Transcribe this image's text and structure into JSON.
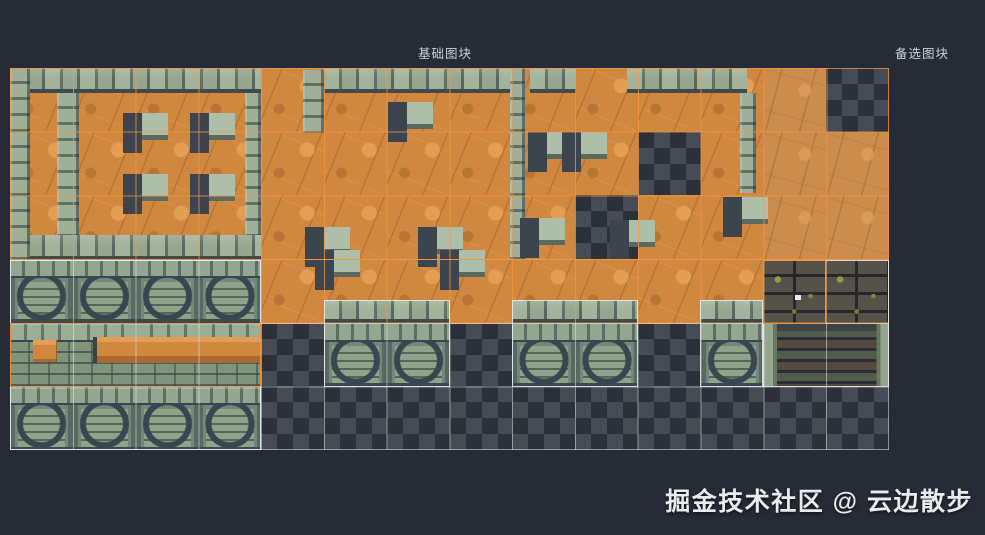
{
  "labels": {
    "base_tiles": "基础图块",
    "alt_tiles": "备选图块"
  },
  "watermark": "掘金技术社区 @ 云边散步",
  "colors": {
    "background": "#262b36",
    "accent_orange_grid": "#f59642",
    "selection_orange": "#ef9140",
    "outline_white": "#e9eef2",
    "floor_orange": "#d0883f",
    "floor_tan": "#cc8c4b",
    "wall_green_light": "#a3b29b",
    "wall_green_dark": "#5f7065",
    "wall_face": "#74877b",
    "dark_stone": "#4b4a43",
    "moss_green": "#8d9c40",
    "checker_light": "#474c54",
    "checker_dark": "#2c3038",
    "label_text": "#ccd2db",
    "watermark_text": "#e9ebef"
  },
  "tileset": {
    "origin_x": 10,
    "origin_y": 68,
    "tile_w": 62.79,
    "tile_h": 63.67,
    "cols": 14,
    "rows": 6,
    "legend": {
      "FL": "orange-floor",
      "FLL": "tan-floor",
      "CK": "transparent-checker",
      "WF": "arched-brick-wall",
      "WL": "ledge-brick-wall",
      "DS": "dark-mossy-stone",
      "DWL": "dark-pit-wall-left",
      "DWR": "dark-pit-wall-right"
    },
    "map": [
      [
        "FL",
        "FL",
        "FL",
        "FL",
        "FL",
        "FL",
        "FL",
        "FL",
        "FL",
        "FL",
        "FL",
        "FL",
        "FLL",
        "CK"
      ],
      [
        "FL",
        "FL",
        "FL",
        "FL",
        "FL",
        "FL",
        "FL",
        "FL",
        "FL",
        "FL",
        "CK",
        "FL",
        "FLL",
        "FLL"
      ],
      [
        "FL",
        "FL",
        "FL",
        "FL",
        "FL",
        "FL",
        "FL",
        "FL",
        "FL",
        "CK",
        "FL",
        "FL",
        "FLL",
        "FLL"
      ],
      [
        "WF",
        "WF",
        "WF",
        "WF",
        "FL",
        "FL",
        "FL",
        "FL",
        "FL",
        "FL",
        "FL",
        "FL",
        "DS",
        "DS"
      ],
      [
        "WL",
        "WL",
        "WL",
        "WL",
        "CK",
        "WF",
        "WF",
        "CK",
        "WF",
        "WF",
        "CK",
        "WF",
        "DWL",
        "DWR"
      ],
      [
        "WF",
        "WF",
        "WF",
        "WF",
        "CK",
        "CK",
        "CK",
        "CK",
        "CK",
        "CK",
        "CK",
        "CK",
        "CK",
        "CK"
      ]
    ]
  },
  "decor": {
    "pillar_size": [
      45,
      40
    ],
    "wall_tops": [
      [
        0,
        0,
        251,
        25
      ],
      [
        0,
        167,
        251,
        25
      ],
      [
        314,
        0,
        188,
        25
      ],
      [
        520,
        0,
        46,
        25
      ],
      [
        617,
        0,
        120,
        25
      ],
      [
        314,
        232,
        126,
        23
      ],
      [
        502,
        232,
        126,
        23
      ],
      [
        690,
        232,
        63,
        23
      ]
    ],
    "wall_columns": [
      [
        0,
        0,
        20,
        192
      ],
      [
        47,
        25,
        22,
        142
      ],
      [
        235,
        25,
        16,
        142
      ],
      [
        500,
        0,
        15,
        192
      ],
      [
        730,
        25,
        16,
        100
      ],
      [
        293,
        2,
        21,
        63
      ]
    ],
    "pillars": [
      [
        113,
        45
      ],
      [
        180,
        45
      ],
      [
        113,
        106
      ],
      [
        180,
        106
      ],
      [
        378,
        34
      ],
      [
        518,
        64
      ],
      [
        552,
        64
      ],
      [
        295,
        159
      ],
      [
        408,
        159
      ],
      [
        510,
        150
      ],
      [
        600,
        152
      ],
      [
        305,
        182
      ],
      [
        430,
        182
      ],
      [
        713,
        129
      ]
    ],
    "extras": [
      {
        "r": [
          83,
          269,
          16,
          26
        ],
        "cls": "x-shadow",
        "name": "ledge-shadow-decor"
      },
      {
        "r": [
          87,
          269,
          164,
          26
        ],
        "cls": "x-ledge",
        "name": "ledge-band-decor"
      },
      {
        "r": [
          23,
          272,
          24,
          22
        ],
        "cls": "x-ledge",
        "name": "ledge-square-decor"
      },
      {
        "r": [
          785,
          227,
          6,
          5
        ],
        "cls": "x-dot",
        "name": "highlight-pixel-decor"
      }
    ]
  },
  "grids": [
    {
      "r": [
        0,
        0,
        879,
        192
      ],
      "kind": "orange"
    },
    {
      "r": [
        251,
        191,
        628,
        65
      ],
      "kind": "orange"
    },
    {
      "r": [
        0,
        192,
        251,
        190
      ],
      "kind": "white"
    },
    {
      "r": [
        251,
        255,
        628,
        127
      ],
      "kind": "white"
    }
  ],
  "outlines": [
    {
      "r": [
        0,
        192,
        251,
        190
      ],
      "kind": "white"
    },
    {
      "r": [
        314,
        232,
        126,
        87
      ],
      "kind": "white"
    },
    {
      "r": [
        502,
        232,
        126,
        87
      ],
      "kind": "white"
    },
    {
      "r": [
        690,
        232,
        63,
        87
      ],
      "kind": "white"
    },
    {
      "r": [
        753,
        192,
        126,
        127
      ],
      "kind": "white"
    },
    {
      "r": [
        0,
        255,
        251,
        64
      ],
      "kind": "orange"
    },
    {
      "r": [
        753,
        192,
        63,
        64
      ],
      "kind": "orange"
    }
  ]
}
